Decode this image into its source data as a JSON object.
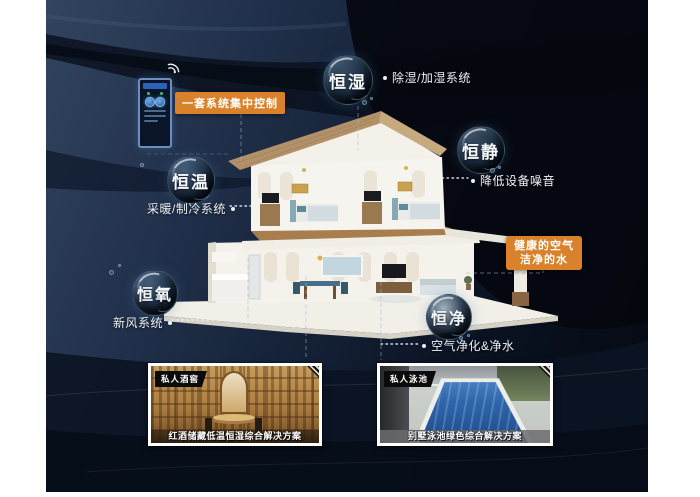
{
  "artwork": {
    "bubbles": [
      {
        "id": "humidity",
        "label": "恒湿"
      },
      {
        "id": "quiet",
        "label": "恒静"
      },
      {
        "id": "temperature",
        "label": "恒温"
      },
      {
        "id": "oxygen",
        "label": "恒氧"
      },
      {
        "id": "purity",
        "label": "恒净"
      }
    ],
    "annotations": [
      {
        "id": "dehumidify",
        "text": "除湿/加湿系统"
      },
      {
        "id": "noise",
        "text": "降低设备噪音"
      },
      {
        "id": "heating",
        "text": "采暖/制冷系统"
      },
      {
        "id": "fresh-air",
        "text": "新风系统"
      },
      {
        "id": "purification",
        "text": "空气净化&净水"
      }
    ],
    "callouts": [
      {
        "id": "central-control",
        "text": "一套系统集中控制"
      },
      {
        "id": "healthy-air-water",
        "line1": "健康的空气",
        "line2": "洁净的水"
      }
    ],
    "photos": [
      {
        "id": "wine-cellar",
        "tag": "私人酒窖",
        "caption": "红酒储藏低温恒湿综合解决方案"
      },
      {
        "id": "pool",
        "tag": "私人泳池",
        "caption": "别墅泳池绿色综合解决方案"
      }
    ],
    "colors": {
      "accent_orange": "#d9822b",
      "background_navy": "#24344f",
      "background_dark": "#05080f",
      "text_light": "#eef2f7"
    }
  }
}
